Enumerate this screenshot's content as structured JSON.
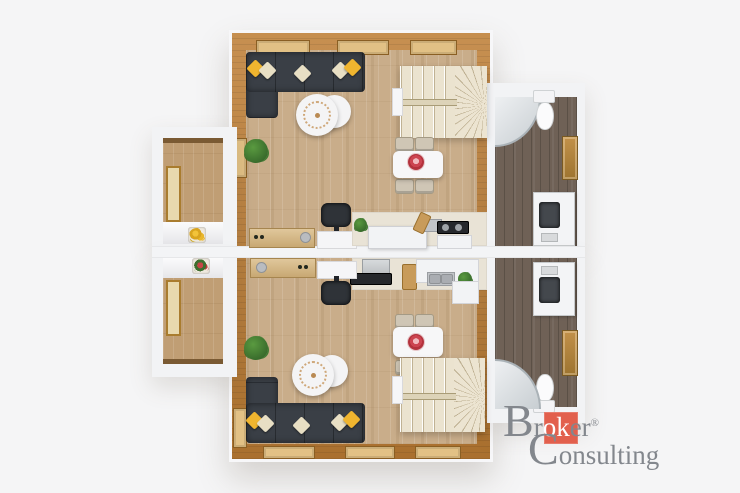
{
  "brand": {
    "line1": {
      "initial": "B",
      "before_highlight": "r",
      "highlight": "ok",
      "after_highlight": "er",
      "registered": "®"
    },
    "line2": {
      "initial": "C",
      "rest": "onsulting"
    },
    "colors": {
      "text": "#83878d",
      "accent_square": "#e2604d",
      "highlight_text": "#ffffff"
    }
  },
  "plan": {
    "type": "3d-top-down-floor-plan-render",
    "units": [
      {
        "name": "upper-apartment",
        "rooms": [
          "living-room",
          "kitchen",
          "winder-staircase",
          "balcony",
          "bathroom"
        ]
      },
      {
        "name": "lower-apartment",
        "rooms": [
          "living-room",
          "kitchen",
          "winder-staircase",
          "balcony",
          "bathroom"
        ]
      }
    ],
    "furniture_per_unit": [
      "corner-sofa-with-pillows",
      "two-round-coffee-tables",
      "dining-table-with-4-chairs",
      "potted-plant",
      "desk-with-office-chair",
      "wood-sideboard",
      "kitchen-counter-with-sink-and-cooktop",
      "corner-shower",
      "toilet",
      "washing-machine",
      "balcony-flower-pot"
    ],
    "palette": {
      "background": "#f5f5f6",
      "timber_wall": "#bd7d34",
      "floor_light_oak": "#c9ad8a",
      "floor_balcony": "#c09e74",
      "floor_bathroom_dark": "#6f6156",
      "white_wall": "#f2f3f5",
      "sofa_dark": "#3a3f46",
      "pillow_yellow": "#f0b52f",
      "pillow_cream": "#e8dfc4",
      "stairs_cream": "#ebe3cf",
      "table_white": "#f7f7f8",
      "dining_flower_red": "#cc4450",
      "plant_green": "#3e7a30",
      "window_sill": "#e2c185"
    }
  }
}
